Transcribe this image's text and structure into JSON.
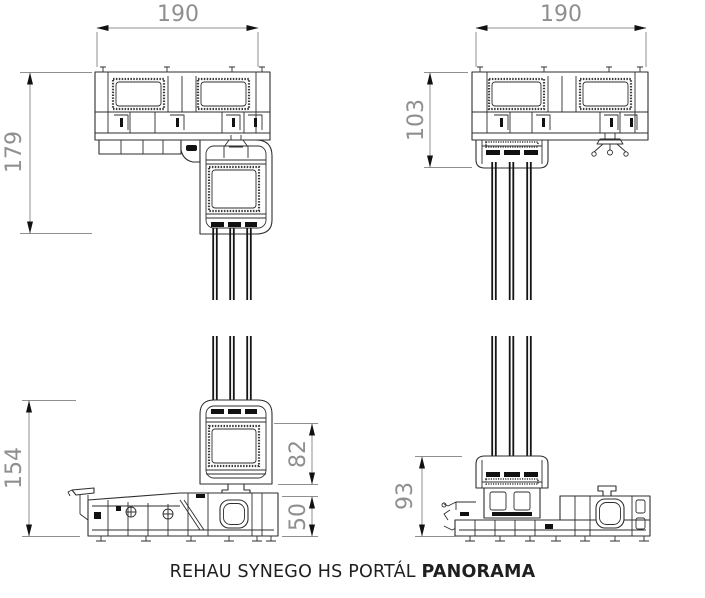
{
  "caption": {
    "regular": "REHAU SYNEGO HS PORTÁL",
    "bold": "PANORAMA"
  },
  "dimensions": {
    "top_left_width": "190",
    "top_left_height": "179",
    "top_right_width": "190",
    "top_right_height": "103",
    "bottom_left_height": "154",
    "bottom_left_sash": "82",
    "bottom_left_sill": "50",
    "bottom_right_height": "93"
  },
  "colors": {
    "drawing_line": "#2e2e2e",
    "dimension_line": "#8f8f8f",
    "glass": "#141414",
    "caption_text": "#1f1f1f"
  },
  "drawing_descriptions": {
    "top_left": "head section with sliding sash, triple glazing",
    "top_right": "head section with fixed glazing, triple glazing",
    "bottom_left": "sill section with sliding sash, triple glazing",
    "bottom_right": "sill section with fixed glazing, triple glazing"
  }
}
